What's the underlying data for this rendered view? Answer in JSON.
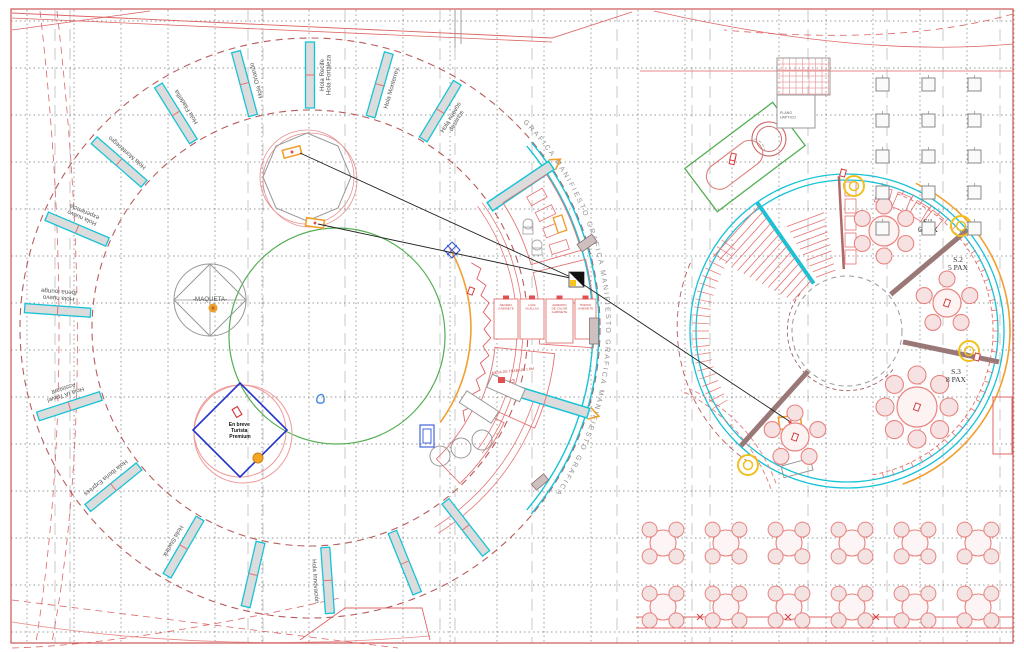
{
  "drawing": {
    "maqueta_label": "-MAQUETA-",
    "coming_soon": [
      "En breve",
      "Turista",
      "Premium"
    ],
    "manifesto_text": "GRAFICA MANIFIESTO   GRAFICA MANIFIESTO   GRAFICA MANIFIESTO   GRAFICA",
    "work_table": "MESA DE TRABAJO 1.8M",
    "work_table_qty": "x3",
    "haptic": [
      "PLANO",
      "HAPTICO"
    ],
    "stands": [
      {
        "angle": 184,
        "lines": [
          "Hola nuevo",
          "Iberia lounge"
        ]
      },
      {
        "angle": 203,
        "lines": [
          "Hola nuevo",
          "experiencia"
        ]
      },
      {
        "angle": 221,
        "lines": [
          "Hola Montenegro"
        ]
      },
      {
        "angle": 238,
        "lines": [
          "Hola Filadelfia"
        ]
      },
      {
        "angle": 255,
        "lines": [
          "Hola Orlando"
        ]
      },
      {
        "angle": 270,
        "lines": [
          "Hola Recife",
          "Hola Fortaleza"
        ]
      },
      {
        "angle": 286,
        "lines": [
          "Hola Monterrey"
        ]
      },
      {
        "angle": 301,
        "lines": [
          "Hola nuevos",
          "destinos"
        ]
      },
      {
        "angle": 162,
        "lines": [
          "Hola IA Travel",
          "Assistant"
        ]
      },
      {
        "angle": 141,
        "lines": [
          "Hola Iberia Express"
        ]
      },
      {
        "angle": 120,
        "lines": [
          "Hola Starlink"
        ]
      },
      {
        "angle": 103,
        "lines": []
      },
      {
        "angle": 86,
        "lines": [
          "Hola Innovación"
        ]
      },
      {
        "angle": 68,
        "lines": []
      },
      {
        "angle": 52,
        "lines": []
      }
    ],
    "sections": [
      {
        "name": "S.1",
        "pax": "6 PAX",
        "x": 928,
        "y": 224
      },
      {
        "name": "S.2",
        "pax": "5 PAX",
        "x": 958,
        "y": 262
      },
      {
        "name": "S.3",
        "pax": "8 PAX",
        "x": 956,
        "y": 374
      }
    ],
    "kitchen_rooms": [
      {
        "lines": [
          "NEVERA",
          "GABINETE"
        ]
      },
      {
        "lines": [
          "LAVA",
          "VAJILLAS"
        ]
      },
      {
        "lines": [
          "ARMARIO",
          "DE CALOR",
          "GABINETE"
        ]
      },
      {
        "lines": [
          "HORNO",
          "GABINETE"
        ]
      }
    ],
    "colors": {
      "cyan": "#17c3d6",
      "red": "#e06666",
      "soft_red": "#e57373",
      "dark_red": "#b85c5c",
      "green": "#54ae54",
      "orange": "#f0a030",
      "yellow": "#f0c020",
      "blue": "#2233cc",
      "brown": "#9a7878",
      "wall_fill": "#dcdcdc"
    }
  }
}
